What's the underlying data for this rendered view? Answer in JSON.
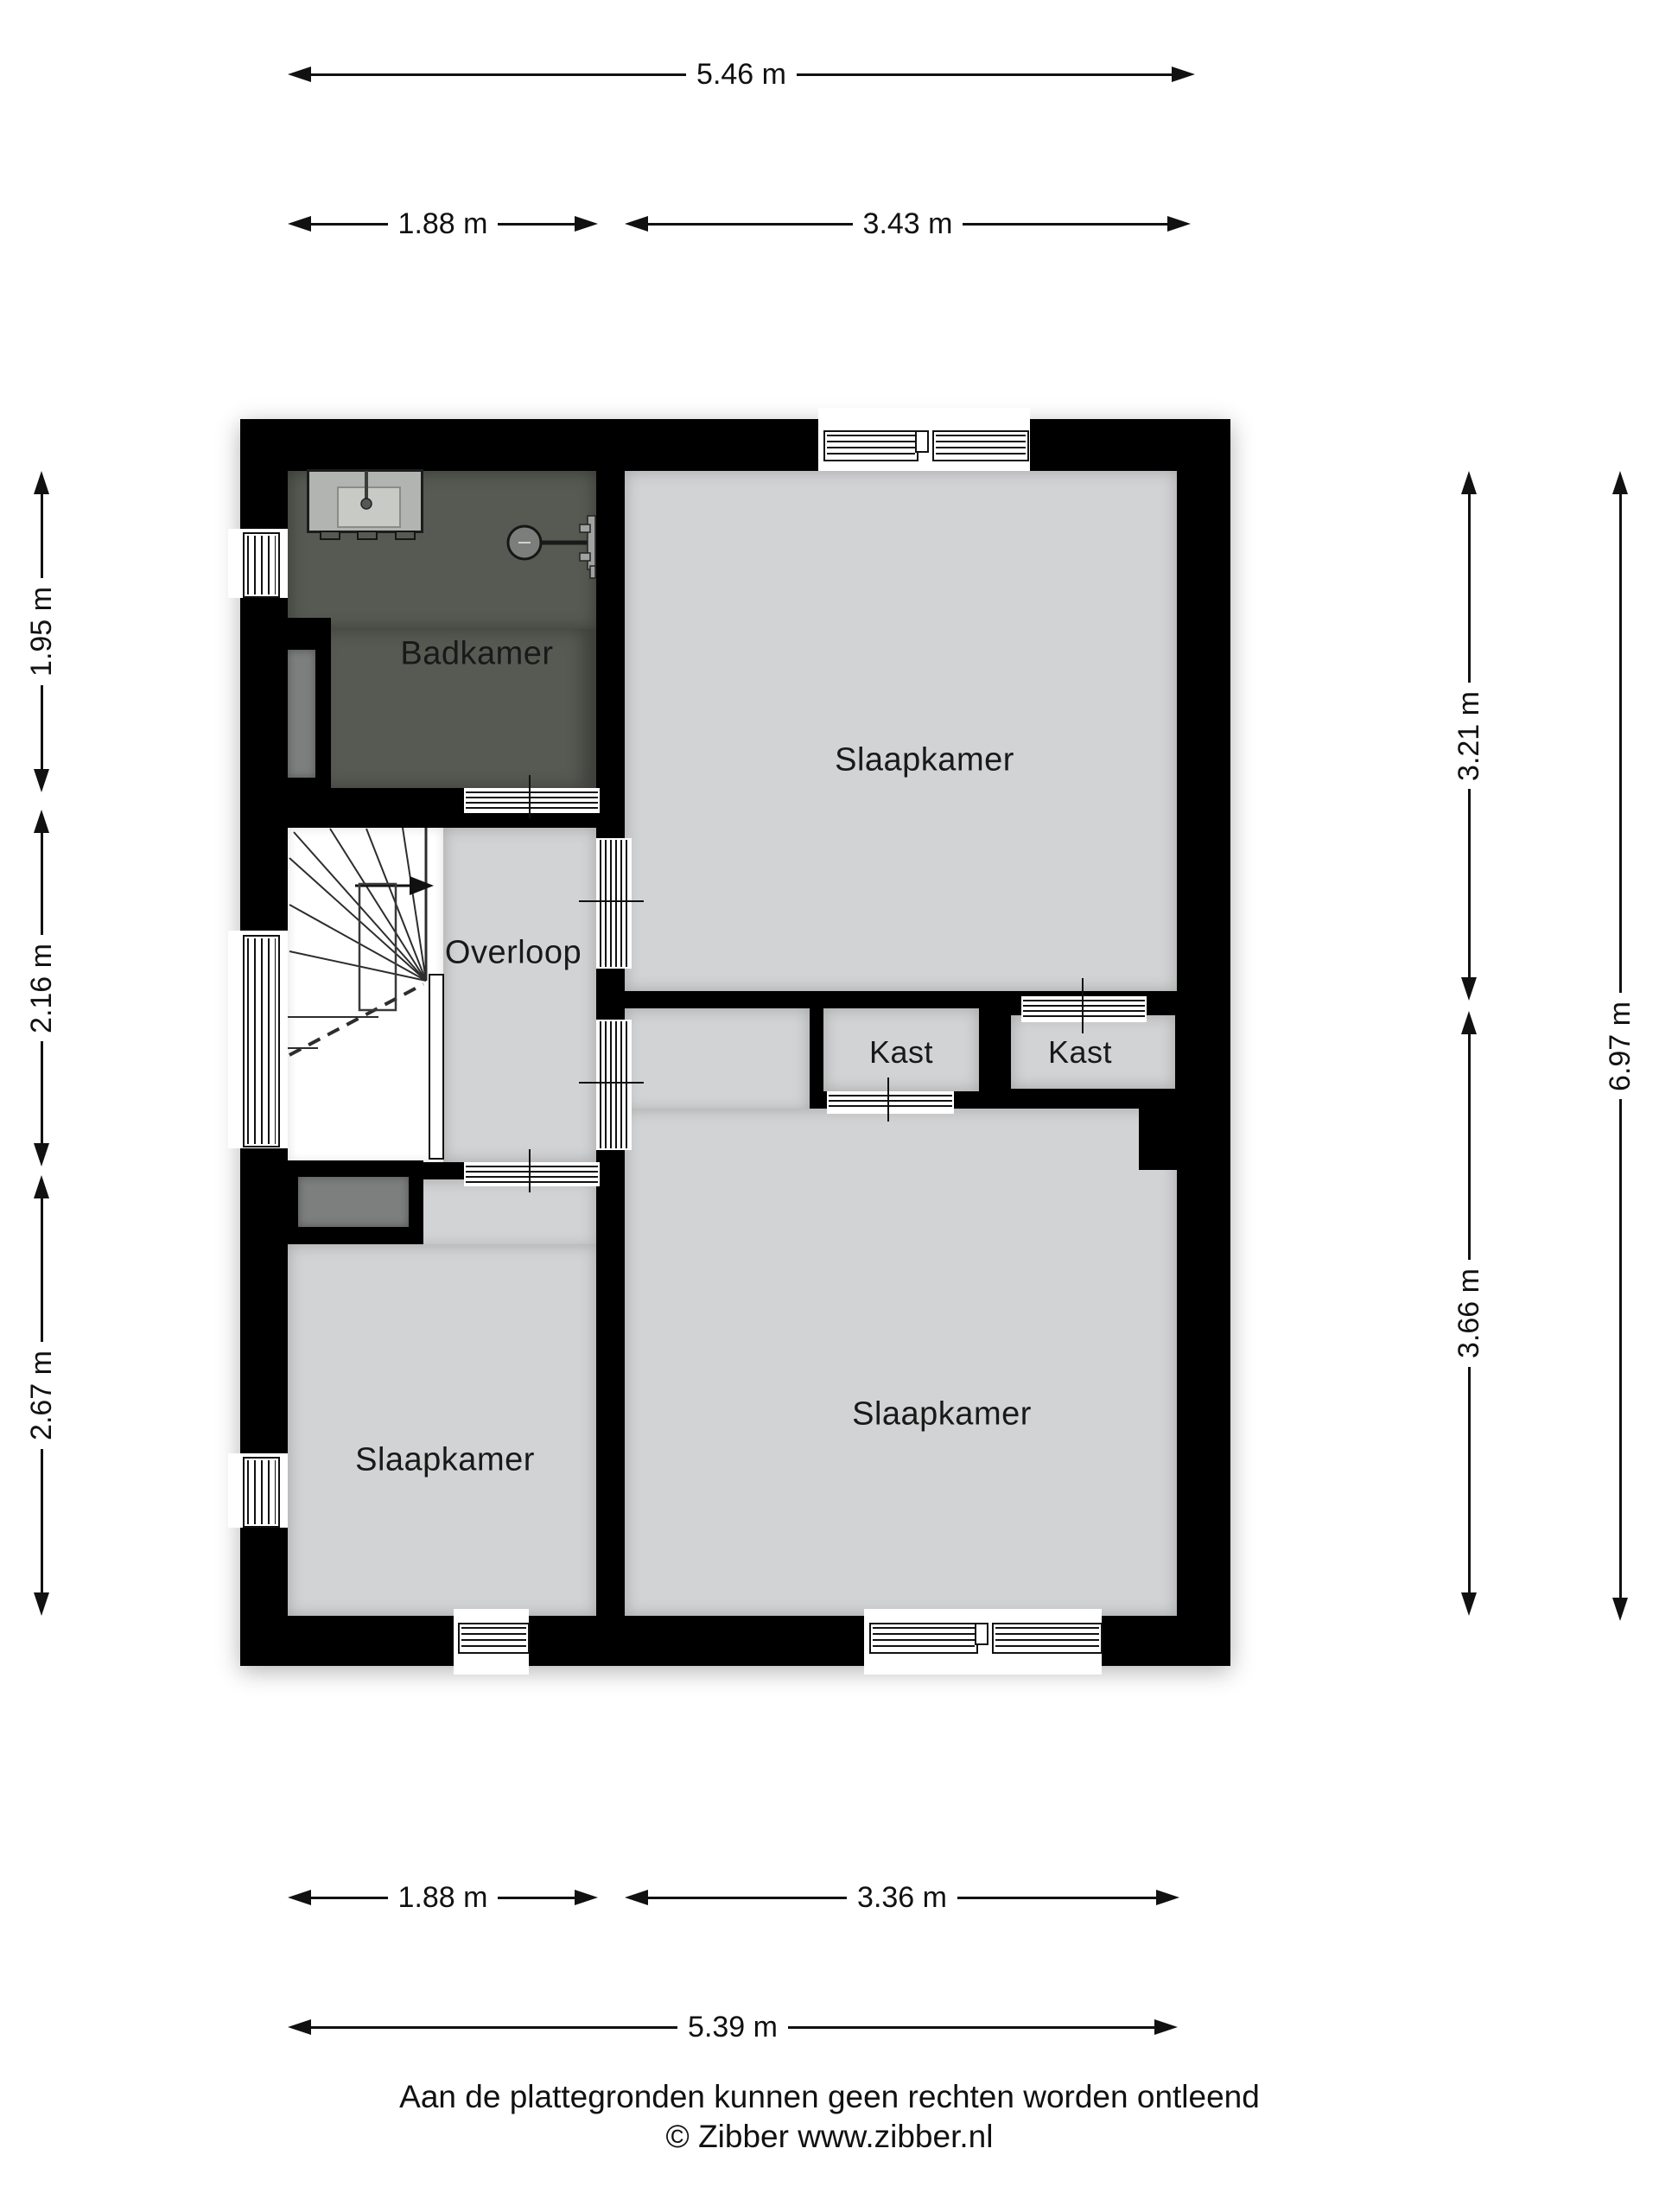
{
  "floorplan": {
    "colors": {
      "wall": "#000000",
      "room_floor": "#d2d3d4",
      "bathroom_floor": "#565a52",
      "shaft_gray": "#7c7f7e",
      "fixture_gray": "#b2b4b2"
    },
    "rooms": {
      "badkamer": "Badkamer",
      "slaapkamer_top": "Slaapkamer",
      "overloop": "Overloop",
      "kast_left": "Kast",
      "kast_right": "Kast",
      "slaapkamer_bottom_left": "Slaapkamer",
      "slaapkamer_bottom_right": "Slaapkamer"
    },
    "dimensions": {
      "top": [
        "5.46 m",
        "1.88 m",
        "3.43 m"
      ],
      "bottom": [
        "1.88 m",
        "3.36 m",
        "5.39 m"
      ],
      "left": [
        "1.95 m",
        "2.16 m",
        "2.67 m"
      ],
      "right": [
        "3.21 m",
        "3.66 m",
        "6.97 m"
      ]
    },
    "footer": {
      "disclaimer": "Aan de plattegronden kunnen geen rechten worden ontleend",
      "credit": "© Zibber www.zibber.nl"
    }
  }
}
